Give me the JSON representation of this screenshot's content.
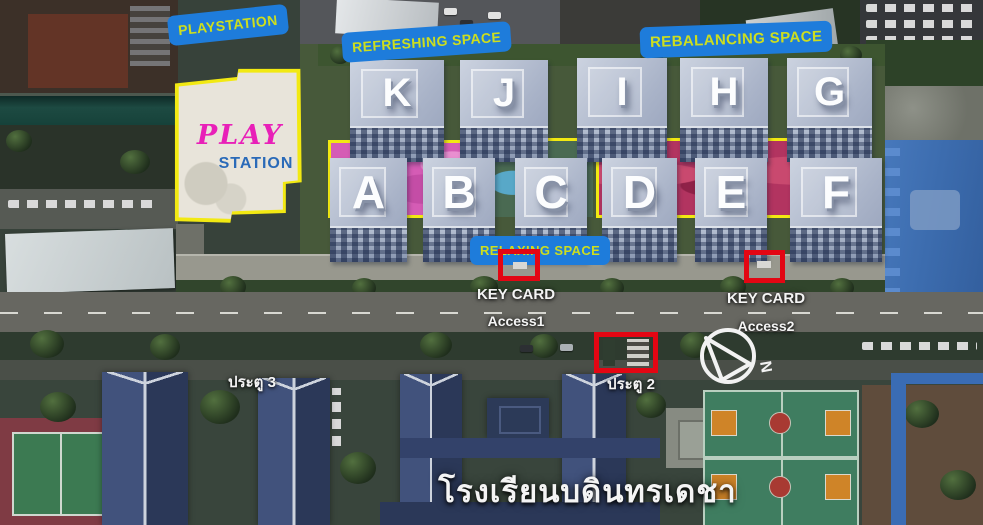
{
  "tags": {
    "playstation": "PLAYSTATION",
    "refreshing": "REFRESHING SPACE",
    "rebalancing": "REBALANCING SPACE",
    "relaxing": "RELAXING SPACE"
  },
  "play_station_area": {
    "line1": "PLAY",
    "line2": "STATION"
  },
  "buildings": {
    "top_row": [
      "K",
      "J",
      "I",
      "H",
      "G"
    ],
    "bottom_row": [
      "A",
      "B",
      "C",
      "D",
      "E",
      "F"
    ]
  },
  "access_points": {
    "access1": {
      "title": "KEY CARD",
      "name": "Access1"
    },
    "access2": {
      "title": "KEY CARD",
      "name": "Access2"
    }
  },
  "gates": {
    "gate3": "ประตู 3",
    "gate2": "ประตู 2"
  },
  "school_name": "โรงเรียนบดินทรเดชา",
  "compass": {
    "label": "N"
  },
  "colors": {
    "tag_background": "#1e7cdb",
    "tag_text": "#cdde1f",
    "highlight_outline": "#f2e912",
    "marker_red": "#e30613",
    "zone_pink": "#d55cb5",
    "zone_crimson": "#b23460",
    "play_text_pink": "#e820b8",
    "station_text_blue": "#2a6ab8"
  }
}
